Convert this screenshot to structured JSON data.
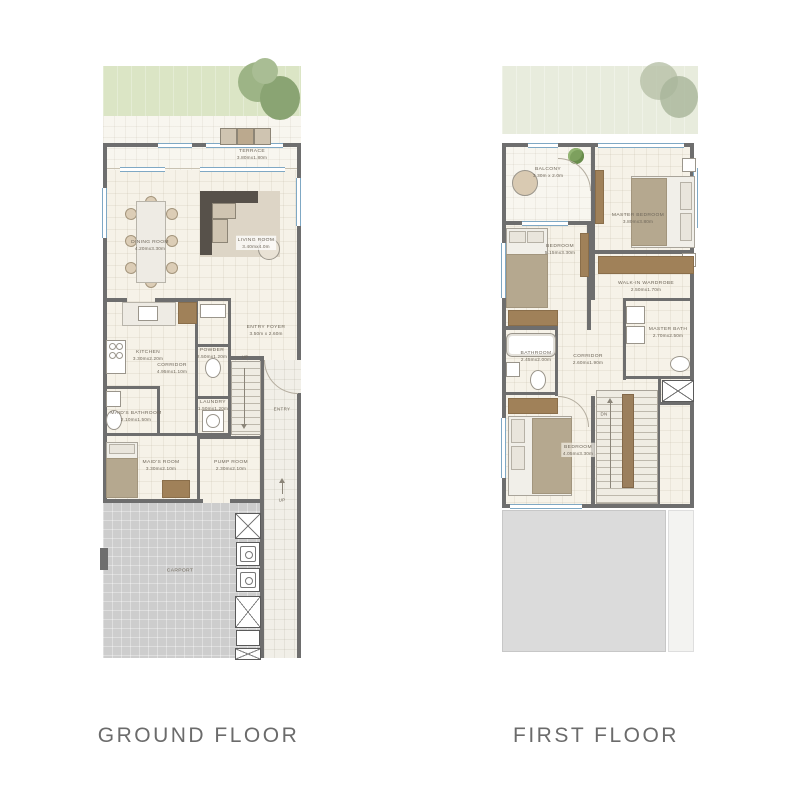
{
  "meta": {
    "kind": "residential floor plan sheet"
  },
  "colors": {
    "wall": "#6e6e6e",
    "floor_cream": "#f6f2e8",
    "garden_green": "#dbe5c5",
    "carport_gray": "#cdcdcd",
    "roof_gray": "#dbdbdb",
    "window_blue": "#7fa8c4",
    "label_text": "#6e6659",
    "title_text": "#6b6b6b"
  },
  "floors": [
    {
      "title": "GROUND FLOOR",
      "rooms": [
        {
          "name": "TERRACE",
          "dims": "3.80mx1.80m"
        },
        {
          "name": "DINING ROOM",
          "dims": "4.20mx3.30m"
        },
        {
          "name": "LIVING ROOM",
          "dims": "3.40mx4.0m"
        },
        {
          "name": "KITCHEN",
          "dims": "3.30mx2.20m"
        },
        {
          "name": "CORRIDOR",
          "dims": "4.95mx1.10m"
        },
        {
          "name": "POWDER",
          "dims": "2.50mx1.20m"
        },
        {
          "name": "ENTRY FOYER",
          "dims": "3.50m x 2.60m"
        },
        {
          "name": "LAUNDRY",
          "dims": "1.50mx1.20m"
        },
        {
          "name": "MAID'S BATHROOM",
          "dims": "2.10mx1.50m"
        },
        {
          "name": "MAID'S ROOM",
          "dims": "3.30mx2.10m"
        },
        {
          "name": "PUMP ROOM",
          "dims": "2.30mx2.10m"
        },
        {
          "name": "CARPORT"
        }
      ],
      "labels": {
        "stairs_up": "UP",
        "entry": "ENTRY",
        "step_up": "UP"
      }
    },
    {
      "title": "FIRST FLOOR",
      "rooms": [
        {
          "name": "BALCONY",
          "dims": "3.30m x 2.0m"
        },
        {
          "name": "MASTER BEDROOM",
          "dims": "3.80mx3.80m"
        },
        {
          "name": "BEDROOM",
          "dims": "5.15mx3.30m"
        },
        {
          "name": "WALK-IN WARDROBE",
          "dims": "2.50mx1.70m"
        },
        {
          "name": "MASTER BATH",
          "dims": "2.70mx2.50m"
        },
        {
          "name": "BATHROOM",
          "dims": "2.45mx2.00m"
        },
        {
          "name": "CORRIDOR",
          "dims": "2.60mx1.90m"
        },
        {
          "name": "BEDROOM",
          "dims": "4.05mx3.30m"
        }
      ],
      "labels": {
        "stairs_down": "DN"
      }
    }
  ]
}
